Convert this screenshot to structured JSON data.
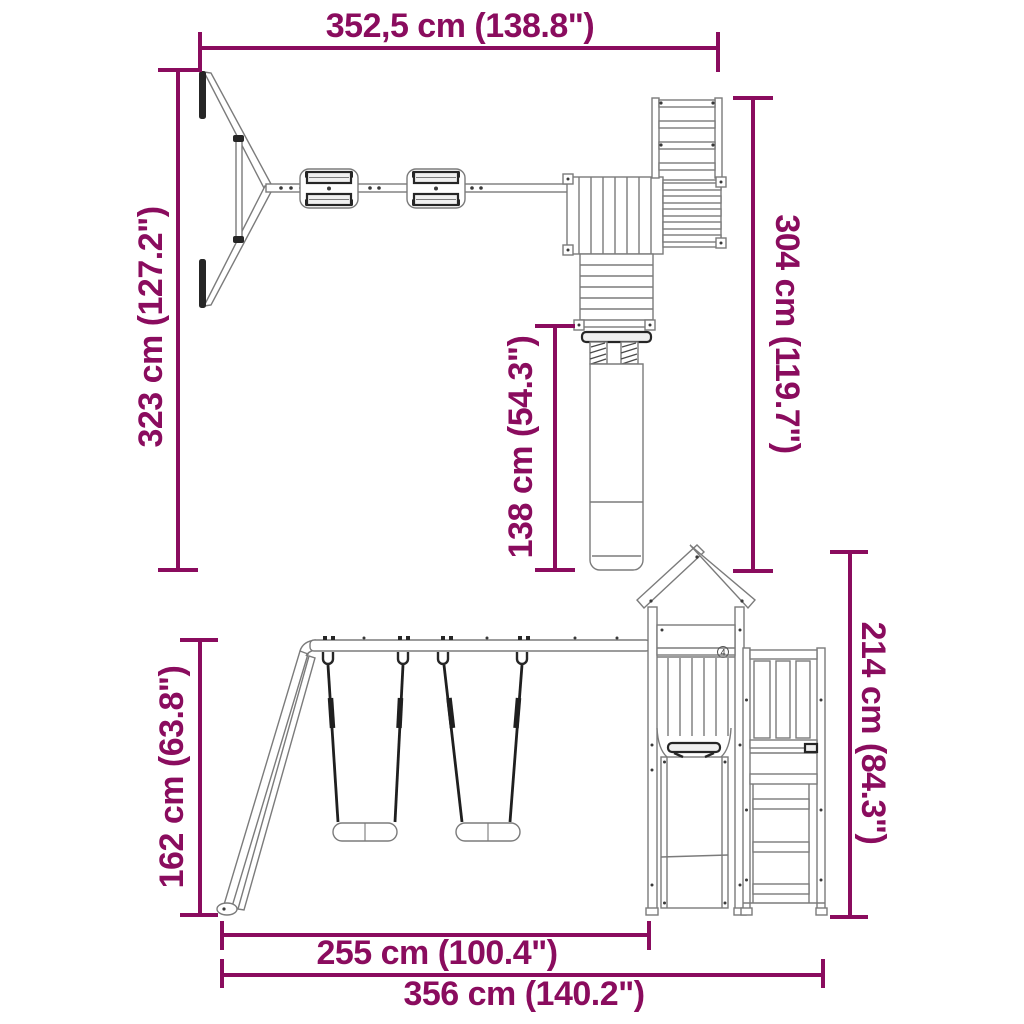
{
  "colors": {
    "dimension_accent": "#8A0C5E",
    "drawing_line": "#7b7b7b",
    "drawing_dark": "#262626",
    "background": "#ffffff"
  },
  "dimensions": {
    "overall_width_top": {
      "label": "352,5 cm (138.8\")"
    },
    "depth_left": {
      "label": "323 cm (127.2\")"
    },
    "tower_depth_right": {
      "label": "304 cm (119.7\")"
    },
    "slide_length": {
      "label": "138 cm (54.3\")"
    },
    "swing_frame_height": {
      "label": "162 cm (63.8\")"
    },
    "tower_height": {
      "label": "214 cm (84.3\")"
    },
    "swing_section_width": {
      "label": "255 cm (100.4\")"
    },
    "overall_length_bottom": {
      "label": "356 cm (140.2\")"
    }
  },
  "part_marker": "4"
}
